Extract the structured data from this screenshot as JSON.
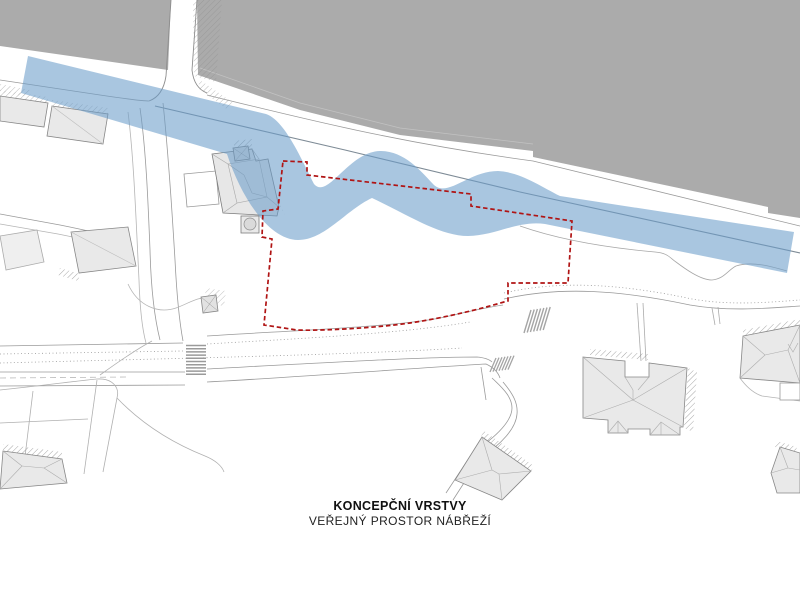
{
  "title": {
    "line1": "KONCEPČNÍ VRSTVY",
    "line2": "VEŘEJNÝ PROSTOR NÁBŘEŽÍ"
  },
  "map": {
    "kind": "urban concept site plan",
    "features": [
      {
        "name": "river-area",
        "description": "large grey water surface, top of plan"
      },
      {
        "name": "bridge",
        "description": "bridge crossing river at upper left"
      },
      {
        "name": "public-space-ribbon",
        "description": "semi-transparent blue wavy band along embankment"
      },
      {
        "name": "site-boundary",
        "description": "red dashed polygon around design site"
      },
      {
        "name": "church-building",
        "description": "building complex with rotunda inside boundary"
      },
      {
        "name": "residential-buildings",
        "description": "grey hip-roof building footprints"
      },
      {
        "name": "street-network",
        "description": "thin grey road and sidewalk lines with crosswalks"
      }
    ]
  },
  "colors": {
    "river": "#ababab",
    "ribbon": "#6b9dca",
    "ribbon_opacity": "0.58",
    "boundary": "#b01414",
    "building_fill": "#e9e9e9",
    "building_stroke": "#878787",
    "roof_line": "#b5b5b5",
    "road_line": "#9a9a9a",
    "quay_line": "#7e8b96",
    "hatch": "#999999"
  }
}
